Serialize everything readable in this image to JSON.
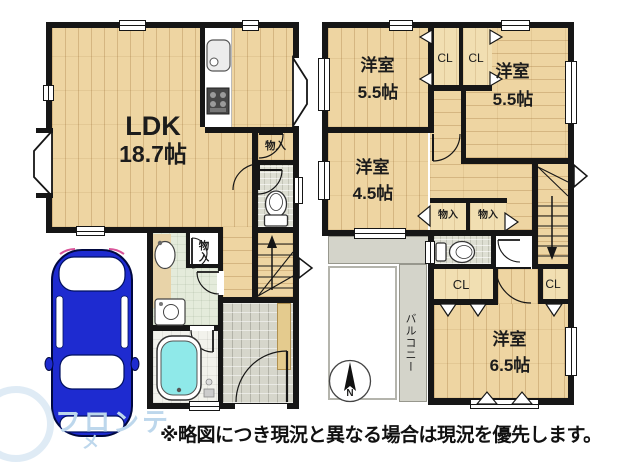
{
  "colors": {
    "wall": "#161616",
    "wood": "#eed5a2",
    "tile": "#d6d6cb",
    "washroom": "#e4ebdb",
    "bath": "#f2f2ec",
    "balcony": "#d4d4ca",
    "tub": "#8fe9e9",
    "car": "#1e2bd0",
    "watermark": "#bdd7ec"
  },
  "floor1": {
    "ldk": {
      "name": "LDK",
      "size": "18.7帖"
    },
    "storage_ldk": "物入",
    "storage_hall": "物入"
  },
  "floor2": {
    "room_nw": {
      "name": "洋室",
      "size": "5.5帖"
    },
    "room_ne": {
      "name": "洋室",
      "size": "5.5帖"
    },
    "room_w": {
      "name": "洋室",
      "size": "4.5帖"
    },
    "room_s": {
      "name": "洋室",
      "size": "6.5帖"
    },
    "closet_nw": "CL",
    "closet_ne": "CL",
    "storage_a": "物入",
    "storage_b": "物入",
    "closet_s": "CL",
    "closet_se": "CL",
    "balcony": "バルコニー"
  },
  "compass": {
    "north": "N"
  },
  "caption": "※略図につき現況と異なる場合は現況を優先します。",
  "watermark": {
    "line1": "フロンテ",
    "line2": "メ"
  }
}
